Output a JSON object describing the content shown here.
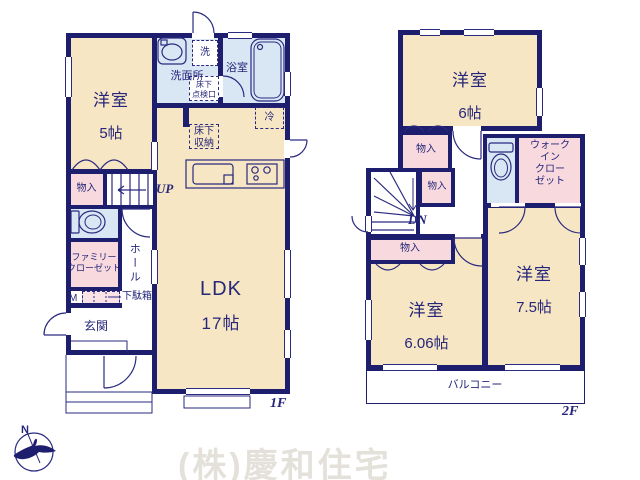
{
  "colors": {
    "wall": "#1e1e6e",
    "line": "#2a2a80",
    "text": "#26267a",
    "room_beige": "#f7e6c3",
    "wet_blue": "#d9e6f4",
    "closet_pink": "#f7d9de",
    "closet_pink_light": "#fae3e7",
    "watermark": "#e3e1da"
  },
  "floor1": {
    "floor_label": "1F",
    "rooms": {
      "yoshitsu5": {
        "name": "洋室",
        "size": "5帖"
      },
      "senmenjo": {
        "label": "洗面所"
      },
      "sen": {
        "label": "洗"
      },
      "yokushitsu": {
        "label": "浴室"
      },
      "tenkenko": {
        "label": "床下\n点検口"
      },
      "yukashita_shuno": {
        "label": "床下\n収納"
      },
      "rei": {
        "label": "冷"
      },
      "monoiri": {
        "label": "物入"
      },
      "stairs_up": {
        "label": "UP"
      },
      "family_closet": {
        "label": "ファミリー\nクローゼット"
      },
      "hall": {
        "label": "ホール"
      },
      "m_mark": {
        "label": "M"
      },
      "getabako": {
        "label": "下駄箱"
      },
      "genkan": {
        "label": "玄関"
      },
      "ldk": {
        "name": "LDK",
        "size": "17帖"
      }
    }
  },
  "floor2": {
    "floor_label": "2F",
    "rooms": {
      "yoshitsu6": {
        "name": "洋室",
        "size": "6帖"
      },
      "monoiri_a": {
        "label": "物入"
      },
      "monoiri_b": {
        "label": "物入"
      },
      "monoiri_c": {
        "label": "物入"
      },
      "stairs_dn": {
        "label": "DN"
      },
      "wic": {
        "label": "ウォーク\nイン\nクロー\nゼット"
      },
      "yoshitsu606": {
        "name": "洋室",
        "size": "6.06帖"
      },
      "yoshitsu75": {
        "name": "洋室",
        "size": "7.5帖"
      },
      "balcony": {
        "label": "バルコニー"
      }
    }
  },
  "compass": {
    "label": "N"
  },
  "watermark": {
    "text": "(株)慶和住宅"
  }
}
